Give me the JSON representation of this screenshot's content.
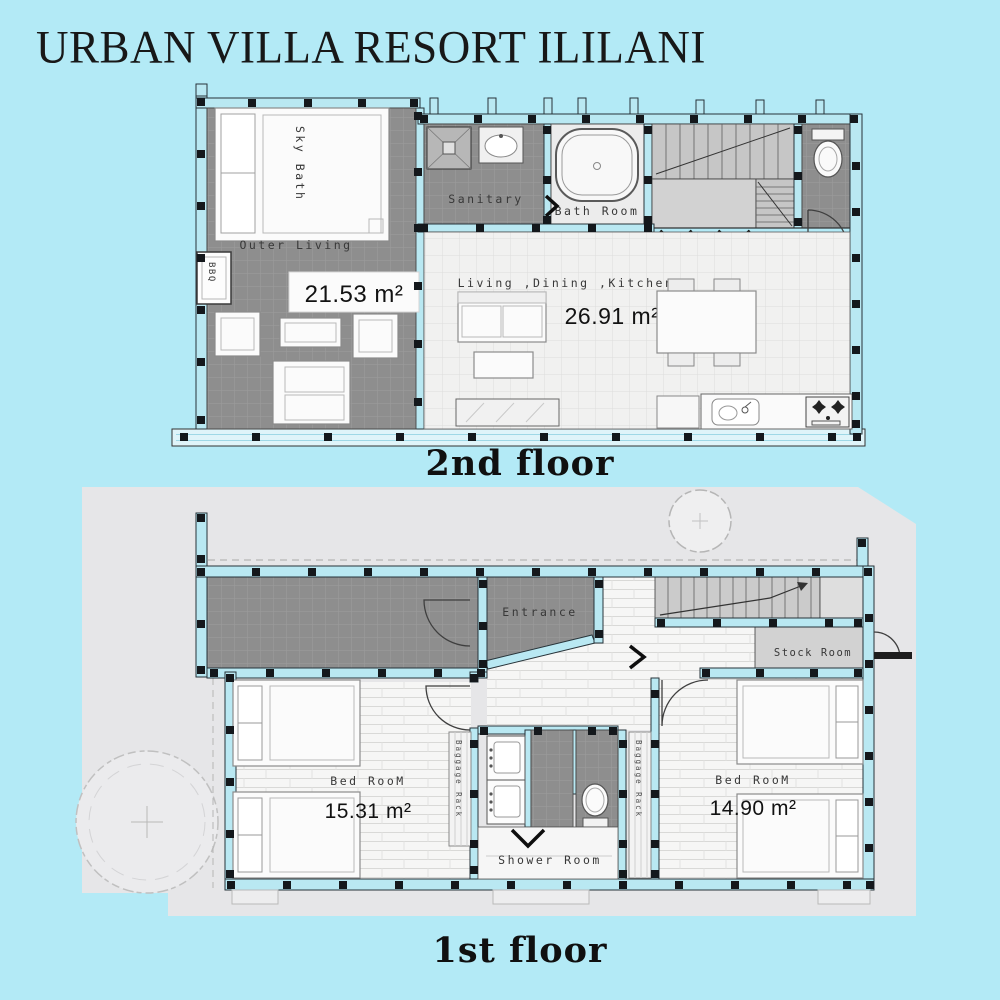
{
  "title": "URBAN VILLA RESORT ILILANI",
  "floor2": {
    "caption": "2nd floor",
    "labels": {
      "sky_bath": "Sky Bath",
      "bbq": "BBQ",
      "outer_living": "Outer Living",
      "outer_living_area": "21.53 m²",
      "sanitary": "Sanitary",
      "bath_room": "Bath Room",
      "ldk": "Living ,Dining ,Kitchen",
      "ldk_area": "26.91 m²"
    }
  },
  "floor1": {
    "caption": "1st floor",
    "labels": {
      "entrance": "Entrance",
      "stock_room": "Stock Room",
      "bedroom_left": "Bed RooM",
      "bedroom_left_area": "15.31 m²",
      "bedroom_right": "Bed RooM",
      "bedroom_right_area": "14.90 m²",
      "shower_room": "Shower Room",
      "baggage_rack_left": "Baggage Rack",
      "baggage_rack_right": "Baggage Rack"
    }
  },
  "colors": {
    "background": "#b3eaf6",
    "dark_tile": "#8e8e8e",
    "wall_blue": "#b9e8f2",
    "site_gray": "#e6e6e8"
  }
}
